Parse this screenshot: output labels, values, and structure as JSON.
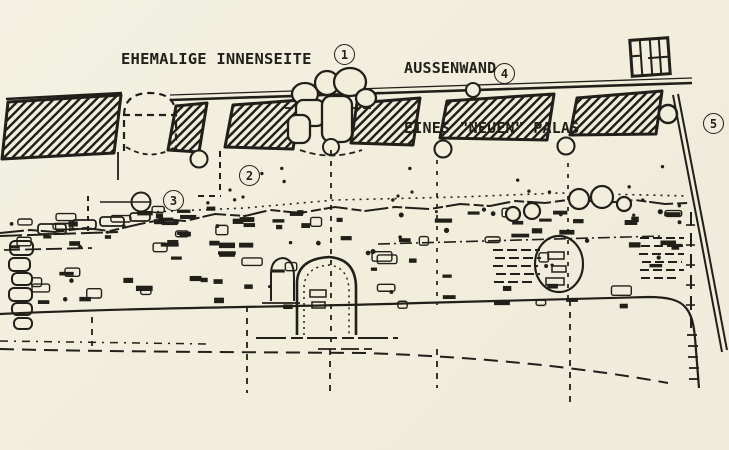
{
  "page": {
    "description": "Scanned archaeological wall plan / elevation drawing",
    "paper_color": "#f1eedc",
    "ink_color": "#221e19"
  },
  "labels": {
    "inner_side": "EHEMALIGE INNENSEITE",
    "outer_wall_line1": "AUSSENWAND",
    "outer_wall_line2": "EINES \"NEUEN\" PALAS"
  },
  "markers": [
    {
      "label": "1"
    },
    {
      "label": "2"
    },
    {
      "label": "3"
    },
    {
      "label": "4"
    },
    {
      "label": "5"
    }
  ],
  "icons": {
    "top_right": "grid-box-icon",
    "wall_fill": "diagonal-hatch-pattern"
  }
}
